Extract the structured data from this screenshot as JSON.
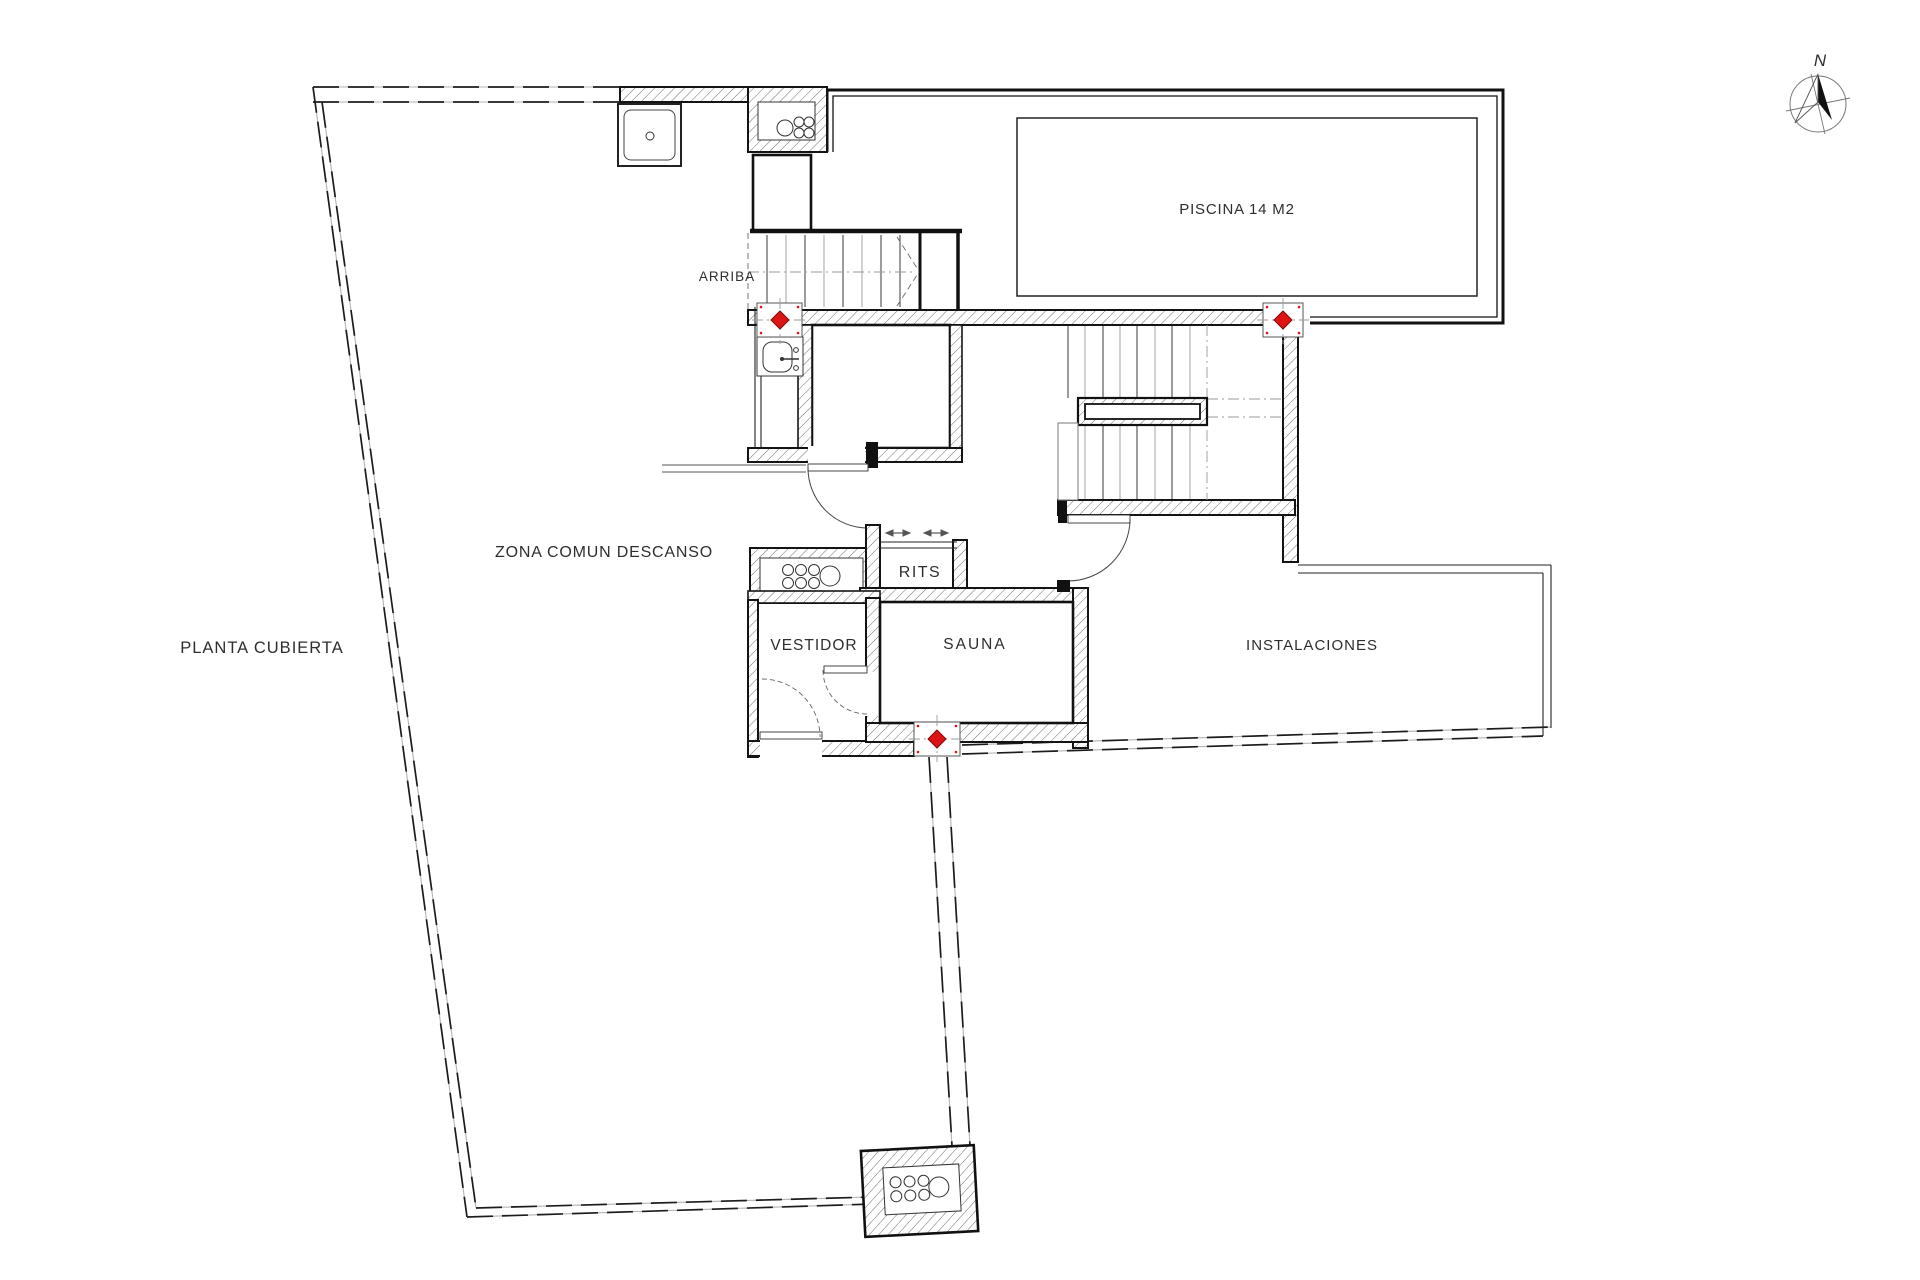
{
  "floor_plan": {
    "title": "PLANTA CUBIERTA",
    "rooms": {
      "zona_comun": "ZONA COMUN DESCANSO",
      "piscina": "PISCINA 14 M2",
      "rits": "RITS",
      "vestidor": "VESTIDOR",
      "sauna": "SAUNA",
      "instalaciones": "INSTALACIONES"
    },
    "annotations": {
      "arriba": "ARRIBA",
      "north": "N"
    },
    "colors": {
      "marker_red": "#dd1414",
      "wall": "#141414",
      "dim_text": "#9c9c9c"
    }
  }
}
